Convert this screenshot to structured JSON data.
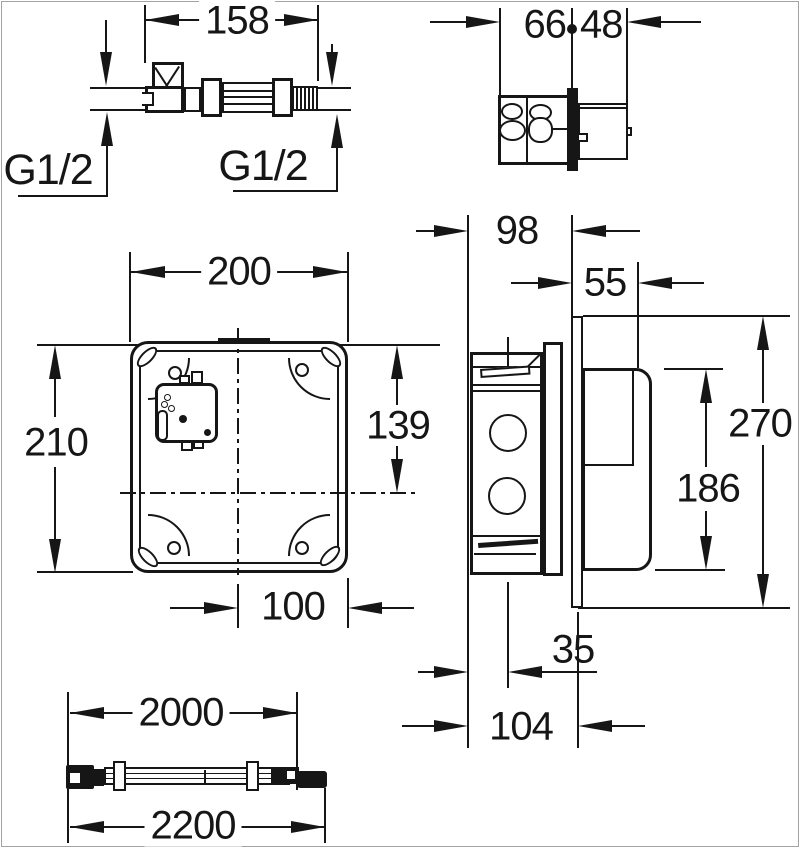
{
  "dims": {
    "valve_length": "158",
    "thread_left": "G1/2",
    "thread_right": "G1/2",
    "box_front": "66",
    "box_rear": "48",
    "front_width": "200",
    "front_height": "210",
    "module_height": "139",
    "bottom_offset": "100",
    "body_depth": "98",
    "cover_width": "55",
    "flange_height": "270",
    "cover_height": "186",
    "outlet_offset": "35",
    "total_depth": "104",
    "hose_length": "2000",
    "hose_total": "2200"
  },
  "colors": {
    "line": "#161616",
    "background": "#ffffff",
    "frame": "#a3a3a3"
  }
}
